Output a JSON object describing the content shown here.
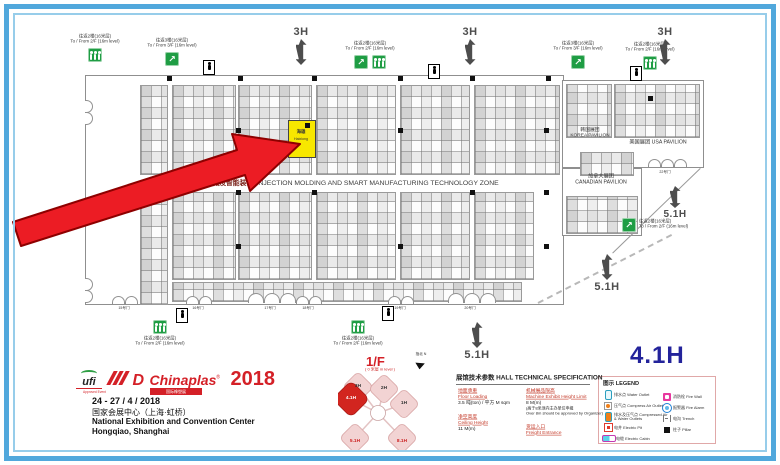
{
  "colors": {
    "frame_blue": "#51a8dc",
    "frame_blue_light": "#97cdea",
    "accent_red": "#d42027",
    "arrow_red": "#ec1c24",
    "highlight_yellow": "#f7e700",
    "hall_navy": "#23239b",
    "escalator_green": "#1f9d44",
    "marker_gray": "#4d4d4d"
  },
  "plan": {
    "zone_cn": "注塑机械及智能装备",
    "zone_en": "INJECTION MOLDING AND SMART MANUFACTURING TECHNOLOGY ZONE",
    "booth_cn": "海雄",
    "booth_en": "Haixiong",
    "esc2f_cn": "往返2楼(16米层)",
    "esc2f_en": "To / From 2/F (16m level)",
    "esc3f_cn": "往返3楼(16米层)",
    "esc3f_en": "To / From 3/F (16m level)",
    "korea_cn": "韩国展团",
    "korea_en": "KOREA PAVILION",
    "usa_cn": "美国展团",
    "usa_en": "USA PAVILION",
    "canada_cn": "加拿大展团",
    "canada_en": "CANADIAN PAVILION",
    "h3": "3H",
    "h51": "5.1H",
    "hall_big": "4.1H",
    "doors": [
      "15号门",
      "16号门",
      "17号门",
      "18号门",
      "19号门",
      "20号门",
      "22号门"
    ]
  },
  "minimap": {
    "title": "1/F",
    "subtitle": "( 0 米层 m level )",
    "north": "指北 N",
    "halls": [
      "3H",
      "2H",
      "4.1H",
      "1H",
      "5.1H",
      "8.1H"
    ]
  },
  "branding": {
    "ufi": "ufi",
    "ufi_sub": "Approved Event",
    "logo_d": "D",
    "name": "Chinaplas",
    "reg": "®",
    "year": "2018",
    "strip": "国际橡塑展",
    "dates": "24 - 27 / 4 / 2018",
    "venue_cn": "国家会展中心（上海·虹桥）",
    "venue_en": "National Exhibition and Convention Center",
    "city": "Hongqiao, Shanghai"
  },
  "spec": {
    "title": "展馆技术参数 HALL TECHNICAL SPECIFICATION",
    "floor_cn": "地面承重",
    "floor_en": "Floor Loading",
    "floor_val": "3.5 吨(ton) / 平方 M sqm",
    "ceiling_cn": "净空高度",
    "ceiling_en": "Ceiling Height",
    "ceiling_val": "11 M(m)",
    "machine_cn": "机械展品限高",
    "machine_en": "Machine Exhibit Height Limit",
    "machine_val": "8 M(m)",
    "note_cn": "(高于8米须向主办单位申报",
    "note_en": "Over 8m should be approved by Organizer)",
    "freight_cn": "货运入口",
    "freight_en": "Freight Entrance"
  },
  "legend": {
    "title": "图示 LEGEND",
    "items_left": [
      {
        "icon": "water-outlet",
        "label": "排水点 Water Outlet"
      },
      {
        "icon": "compressed-air-outlet",
        "label": "压气点 Compress Air Outlet"
      },
      {
        "icon": "air-and-water-outlets",
        "label": "排水及压气点 Compressed Air & Water Outlets"
      },
      {
        "icon": "electric-pit",
        "label": "电井 Electric Pit"
      },
      {
        "icon": "electric-cabin",
        "label": "电缆 Electric Cabin"
      }
    ],
    "items_right": [
      {
        "icon": "fire-wall",
        "label": "消防栓 Fire Wall"
      },
      {
        "icon": "fire-alarm",
        "label": "报警器 Fire Alarm"
      },
      {
        "icon": "trench",
        "label": "电沟 Trench"
      },
      {
        "icon": "pillar",
        "label": "柱子 Pillar"
      }
    ]
  }
}
